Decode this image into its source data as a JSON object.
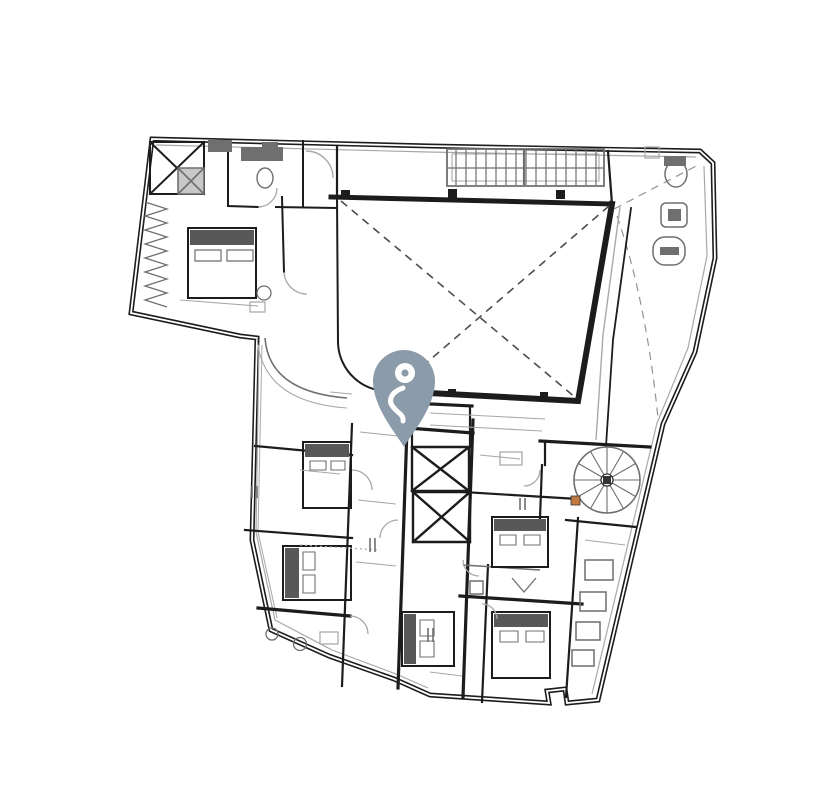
{
  "canvas": {
    "width": 813,
    "height": 800
  },
  "colors": {
    "background": "#ffffff",
    "wall": "#1c1c1c",
    "gray": "#6f6f6f",
    "light_gray": "#a8a8a8",
    "dash": "#4d4d4d",
    "bed_fill": "#585858",
    "shaft_fill": "#c8c8c8",
    "accent_orange": "#bf7a42",
    "pin": "#8c9baa",
    "pin_icon": "#ffffff"
  },
  "pin": {
    "icon": "person-pin-icon",
    "tip_x": 404,
    "tip_y": 447
  },
  "floor_plan": {
    "features": [
      "building-outline",
      "inner-courtyard",
      "courtyard-diagonals",
      "main-staircase",
      "spiral-staircase",
      "elevator-shafts",
      "guest-room-beds",
      "bathroom-fixtures",
      "wardrobe-zigzag",
      "door-swing-arcs"
    ]
  }
}
